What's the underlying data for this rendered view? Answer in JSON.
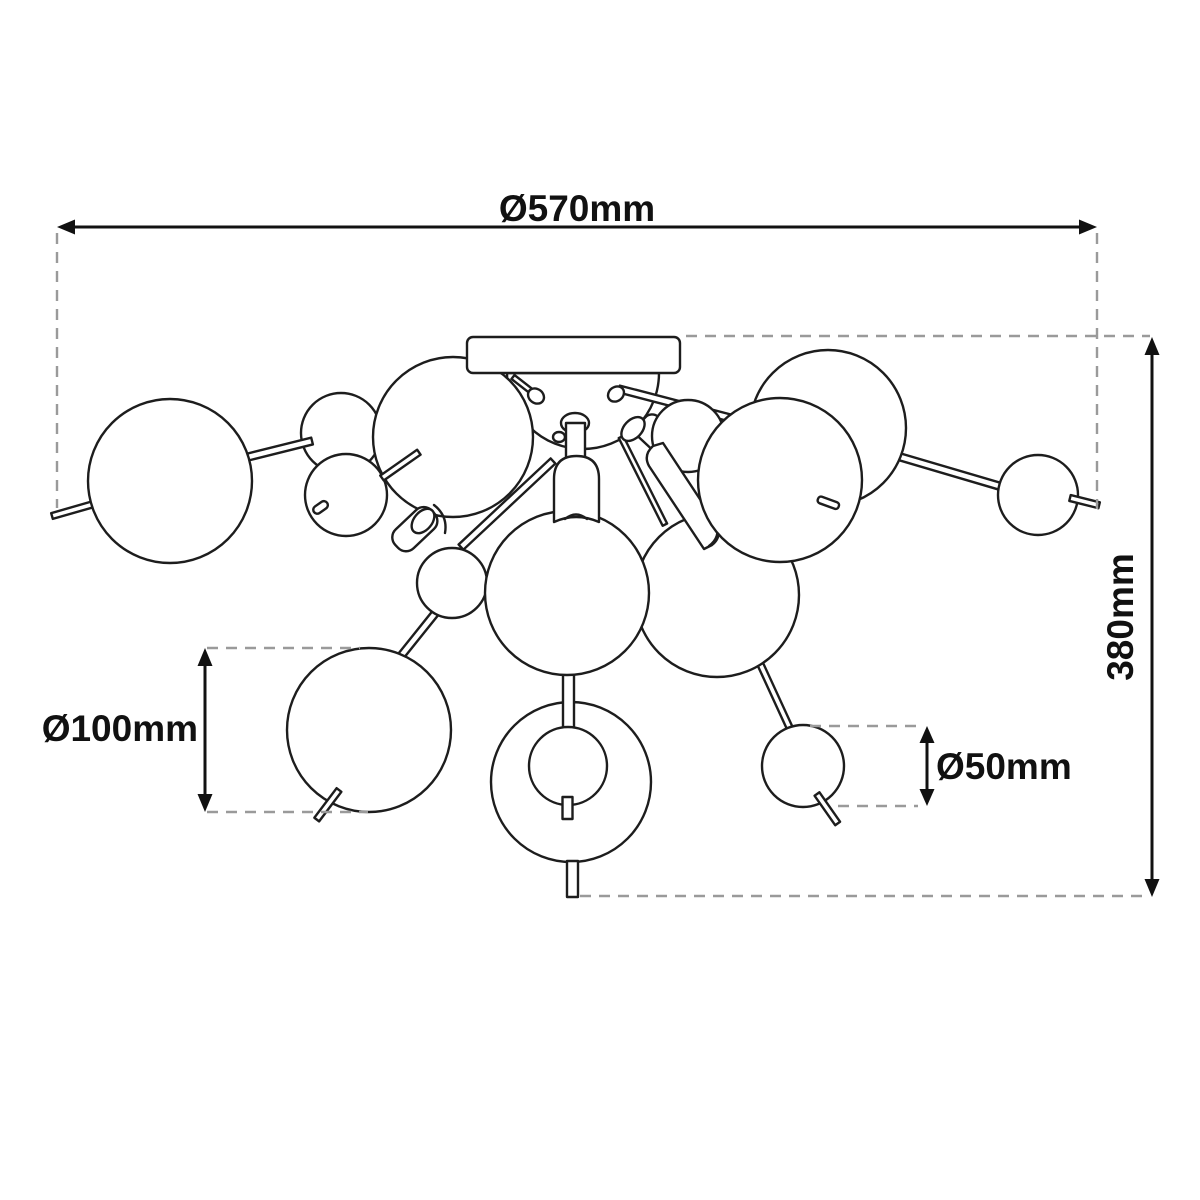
{
  "drawing": {
    "subject": "Ceiling lamp with multiple glass spheres - technical dimension drawing, top/side view",
    "background_color": "#ffffff",
    "outline_color": "#1d1d1d",
    "dashed_guide_color": "#9a9a9a",
    "text_color": "#111111"
  },
  "dimensions": {
    "overall_width": {
      "label": "Ø570mm",
      "value_mm": 570,
      "orientation": "horizontal",
      "position": "top"
    },
    "overall_height": {
      "label": "380mm",
      "value_mm": 380,
      "orientation": "vertical",
      "position": "right"
    },
    "large_sphere": {
      "label": "Ø100mm",
      "value_mm": 100,
      "orientation": "vertical",
      "position": "bottom-left"
    },
    "small_sphere": {
      "label": "Ø50mm",
      "value_mm": 50,
      "orientation": "vertical",
      "position": "bottom-right"
    }
  }
}
